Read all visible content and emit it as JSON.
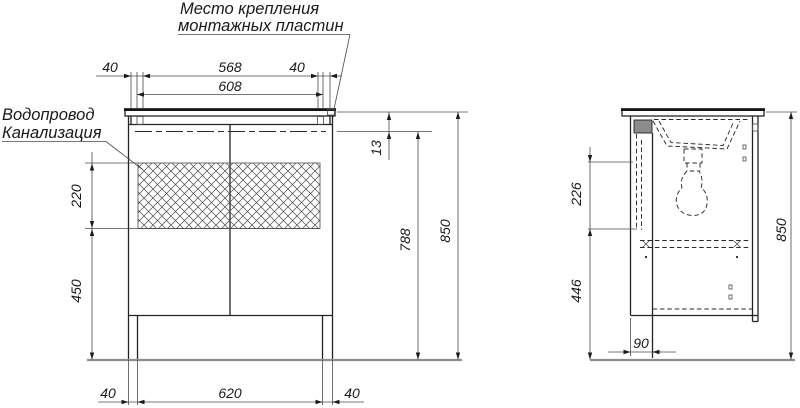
{
  "title": {
    "line1": "Место крепления",
    "line2": "монтажных пластин"
  },
  "labels": {
    "water": "Водопровод",
    "sewer": "Канализация"
  },
  "front": {
    "dim_top_left": "40",
    "dim_top_span": "568",
    "dim_top_right": "40",
    "dim_top_total": "608",
    "dim_drop": "13",
    "dim_hatch": "220",
    "dim_lower": "450",
    "dim_inner_height": "788",
    "dim_height": "850",
    "dim_bot_left": "40",
    "dim_bot_span": "620",
    "dim_bot_right": "40"
  },
  "side": {
    "dim_upper": "226",
    "dim_lower": "446",
    "dim_height": "850",
    "dim_leg": "90"
  }
}
